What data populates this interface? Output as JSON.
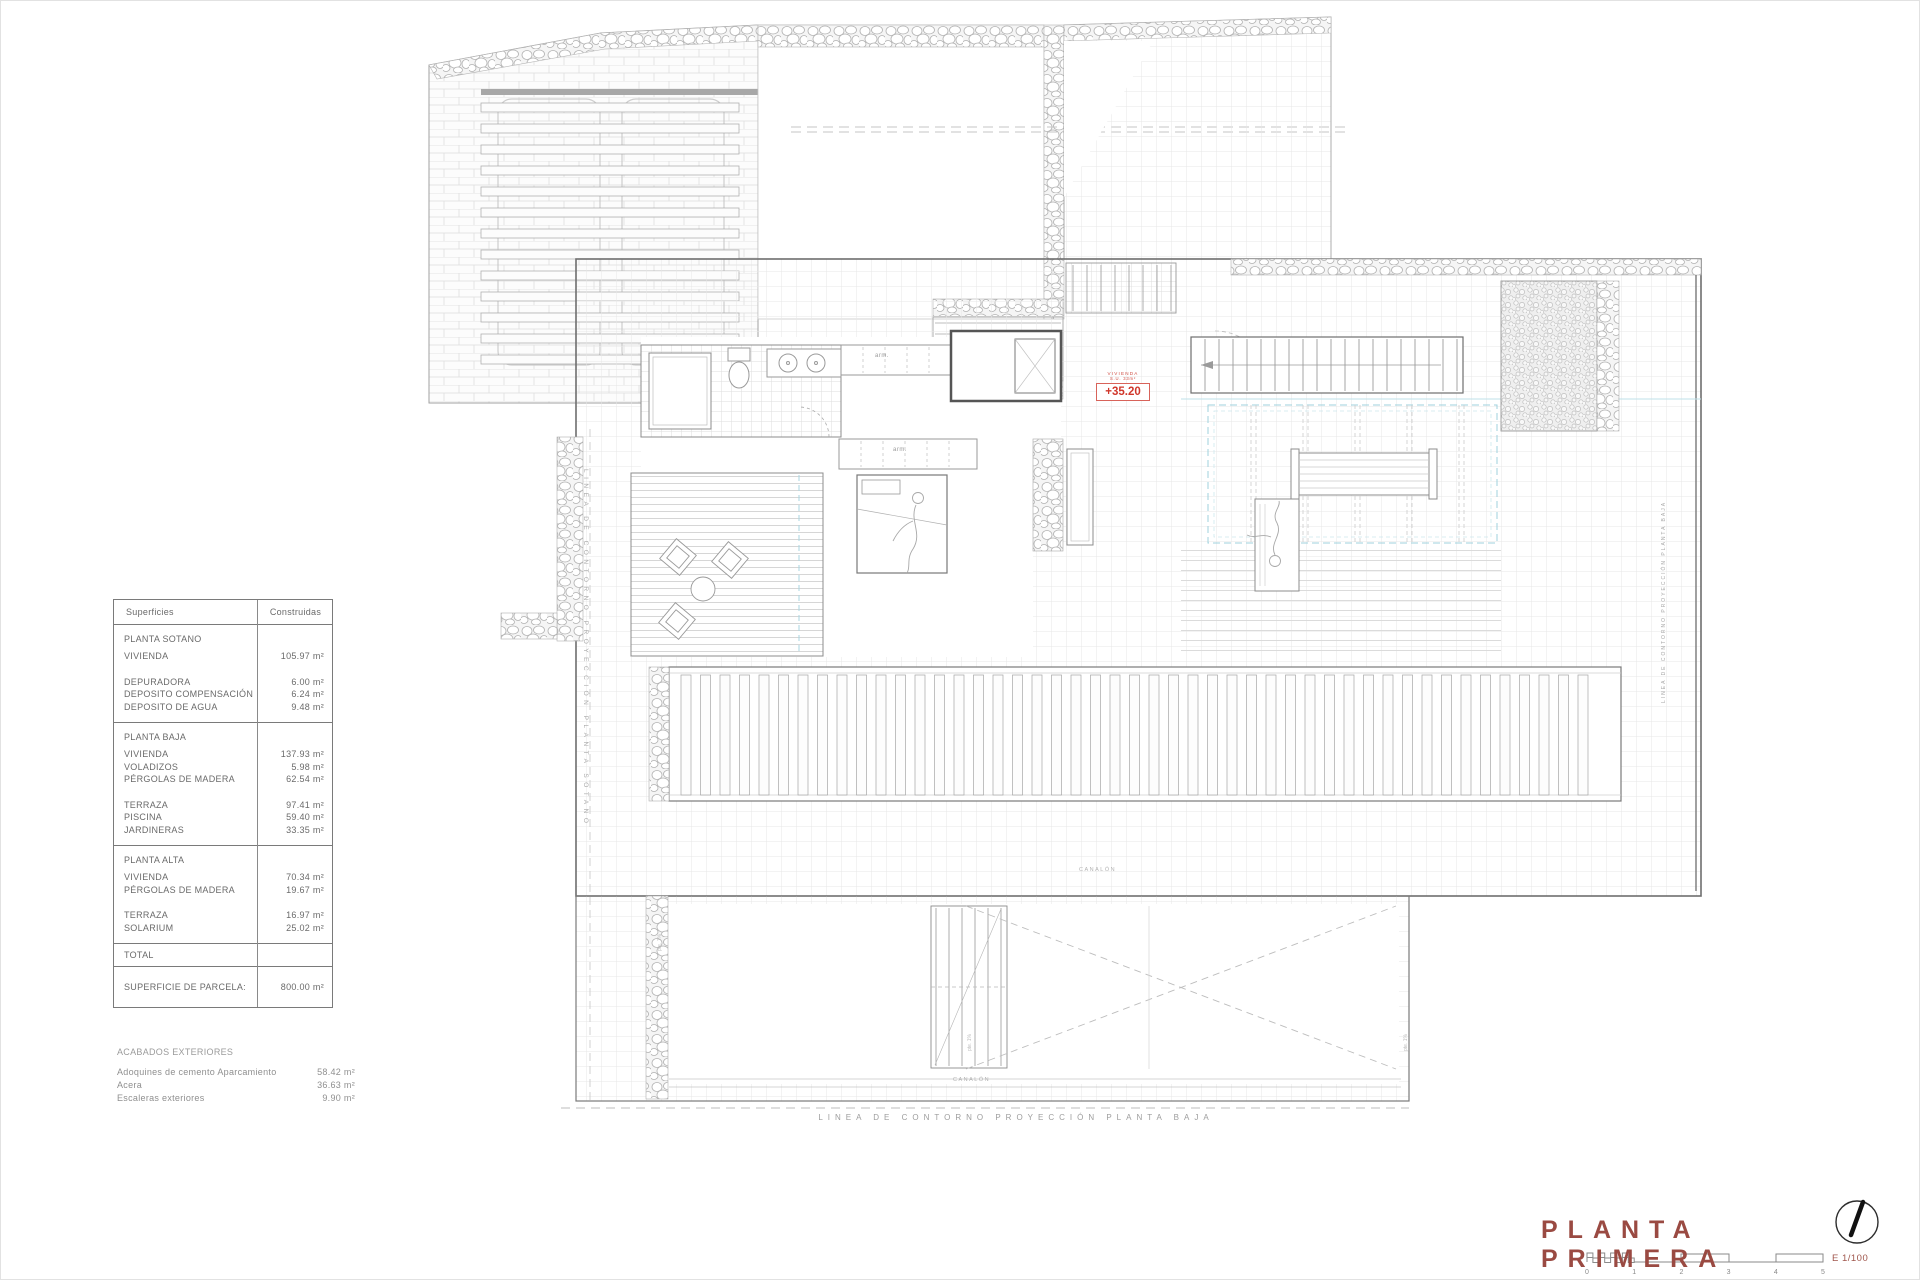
{
  "table": {
    "headers": [
      "Superficies",
      "Construidas"
    ],
    "sections": [
      {
        "name": "PLANTA SOTANO",
        "groups": [
          [
            {
              "label": "VIVIENDA",
              "value": "105.97 m²"
            }
          ],
          [
            {
              "label": "DEPURADORA",
              "value": "6.00 m²"
            },
            {
              "label": "DEPOSITO COMPENSACIÓN",
              "value": "6.24 m²"
            },
            {
              "label": "DEPOSITO DE AGUA",
              "value": "9.48 m²"
            }
          ]
        ]
      },
      {
        "name": "PLANTA BAJA",
        "groups": [
          [
            {
              "label": "VIVIENDA",
              "value": "137.93 m²"
            },
            {
              "label": "VOLADIZOS",
              "value": "5.98 m²"
            },
            {
              "label": "PÉRGOLAS DE MADERA",
              "value": "62.54 m²"
            }
          ],
          [
            {
              "label": "TERRAZA",
              "value": "97.41 m²"
            },
            {
              "label": "PISCINA",
              "value": "59.40 m²"
            },
            {
              "label": "JARDINERAS",
              "value": "33.35 m²"
            }
          ]
        ]
      },
      {
        "name": "PLANTA ALTA",
        "groups": [
          [
            {
              "label": "VIVIENDA",
              "value": "70.34 m²"
            },
            {
              "label": "PÉRGOLAS DE MADERA",
              "value": "19.67 m²"
            }
          ],
          [
            {
              "label": "TERRAZA",
              "value": "16.97 m²"
            },
            {
              "label": "SOLARIUM",
              "value": "25.02 m²"
            }
          ]
        ]
      }
    ],
    "total_label": "TOTAL",
    "parcel": {
      "label": "SUPERFICIE DE PARCELA:",
      "value": "800.00 m²"
    }
  },
  "exteriors": {
    "title": "ACABADOS EXTERIORES",
    "rows": [
      {
        "label": "Adoquines de cemento Aparcamiento",
        "value": "58.42 m²"
      },
      {
        "label": "Acera",
        "value": "36.63 m²"
      },
      {
        "label": "Escaleras exteriores",
        "value": "9.90 m²"
      }
    ]
  },
  "annotations": {
    "contour_left": "LINEA DE CONTORNO PROYECCIÓN PLANTA SOTANO",
    "contour_right": "LINEA DE CONTORNO PROYECCIÓN PLANTA BAJA",
    "contour_bottom": "LINEA DE CONTORNO PROYECCIÓN PLANTA BAJA",
    "wardrobe": "arm.",
    "gutter": "CANALÓN",
    "slope": "pte. 1%"
  },
  "elevation_marker": {
    "room": "VIVIENDA",
    "area_note": "S.U. 33m²",
    "level": "+35.20"
  },
  "title_block": {
    "title": "PLANTA PRIMERA",
    "scale_label": "E 1/100",
    "ticks": [
      "0",
      "1",
      "2",
      "3",
      "4",
      "5"
    ]
  },
  "colors": {
    "accent_red": "#d0372b",
    "title_red": "#9a4a42",
    "pergola_cyan": "#9fd2de"
  }
}
